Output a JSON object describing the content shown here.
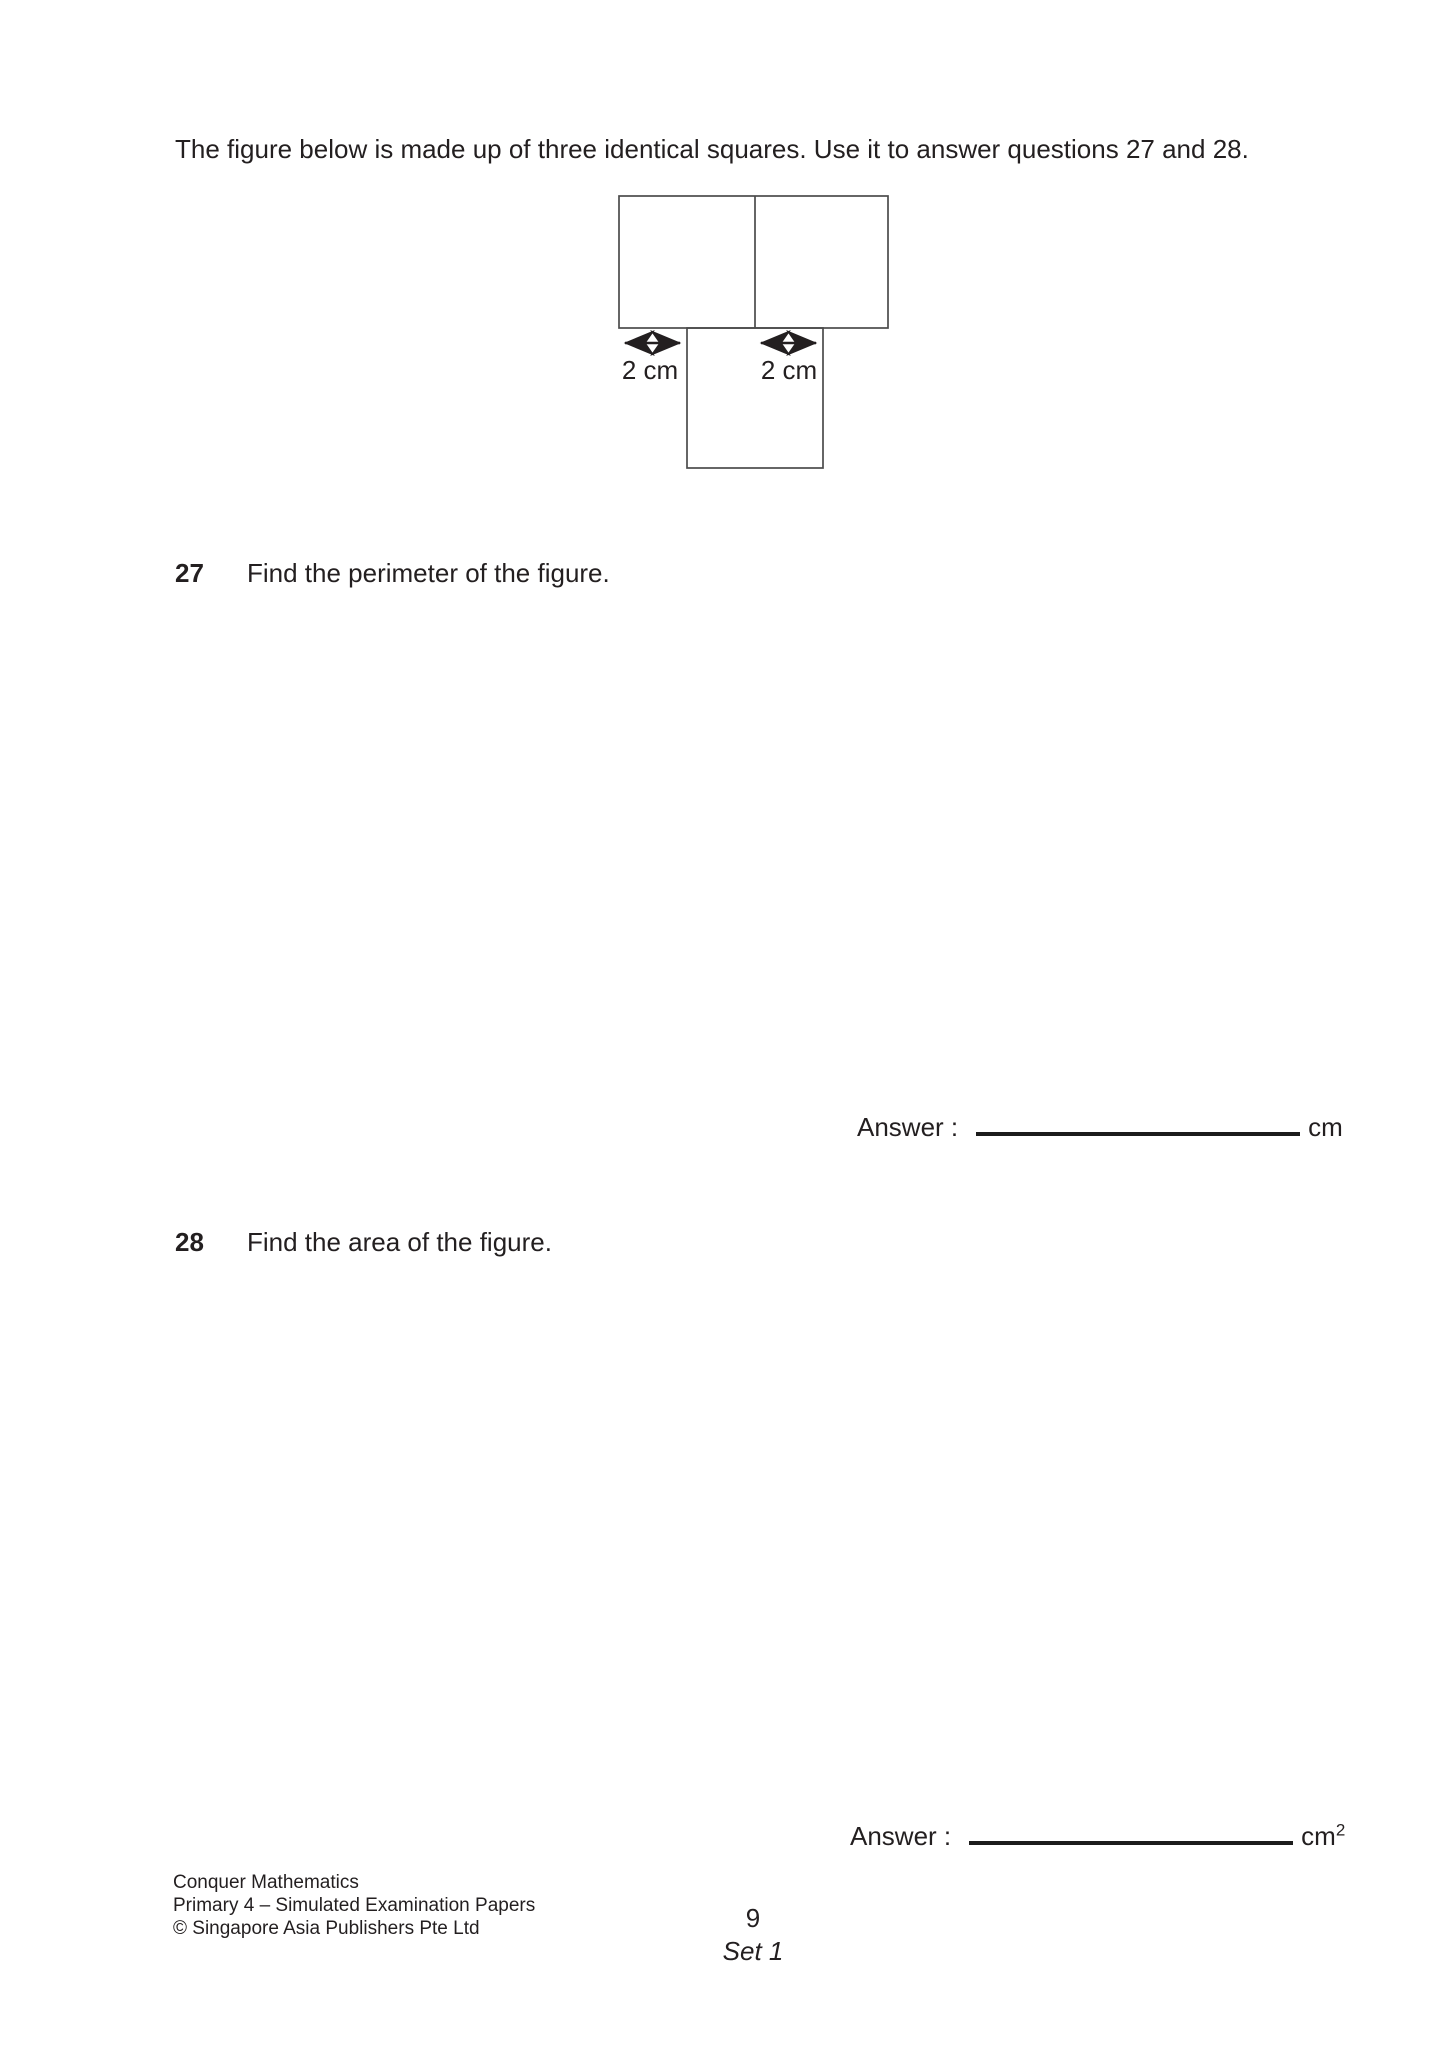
{
  "intro": "The figure below is made up of three identical squares. Use it to answer questions 27 and 28.",
  "figure": {
    "left_dim_label": "2 cm",
    "right_dim_label": "2 cm"
  },
  "question27": {
    "number": "27",
    "text": "Find the perimeter of the figure.",
    "answer_label": "Answer :",
    "answer_unit": "cm"
  },
  "question28": {
    "number": "28",
    "text": "Find the area of the figure.",
    "answer_label": "Answer :",
    "answer_unit": "cm",
    "answer_unit_exponent": "2"
  },
  "footer": {
    "series": "Conquer Mathematics",
    "edition": "Primary 4 – Simulated Examination Papers",
    "copyright": "© Singapore Asia Publishers Pte Ltd",
    "page_number": "9",
    "set_label": "Set 1"
  }
}
